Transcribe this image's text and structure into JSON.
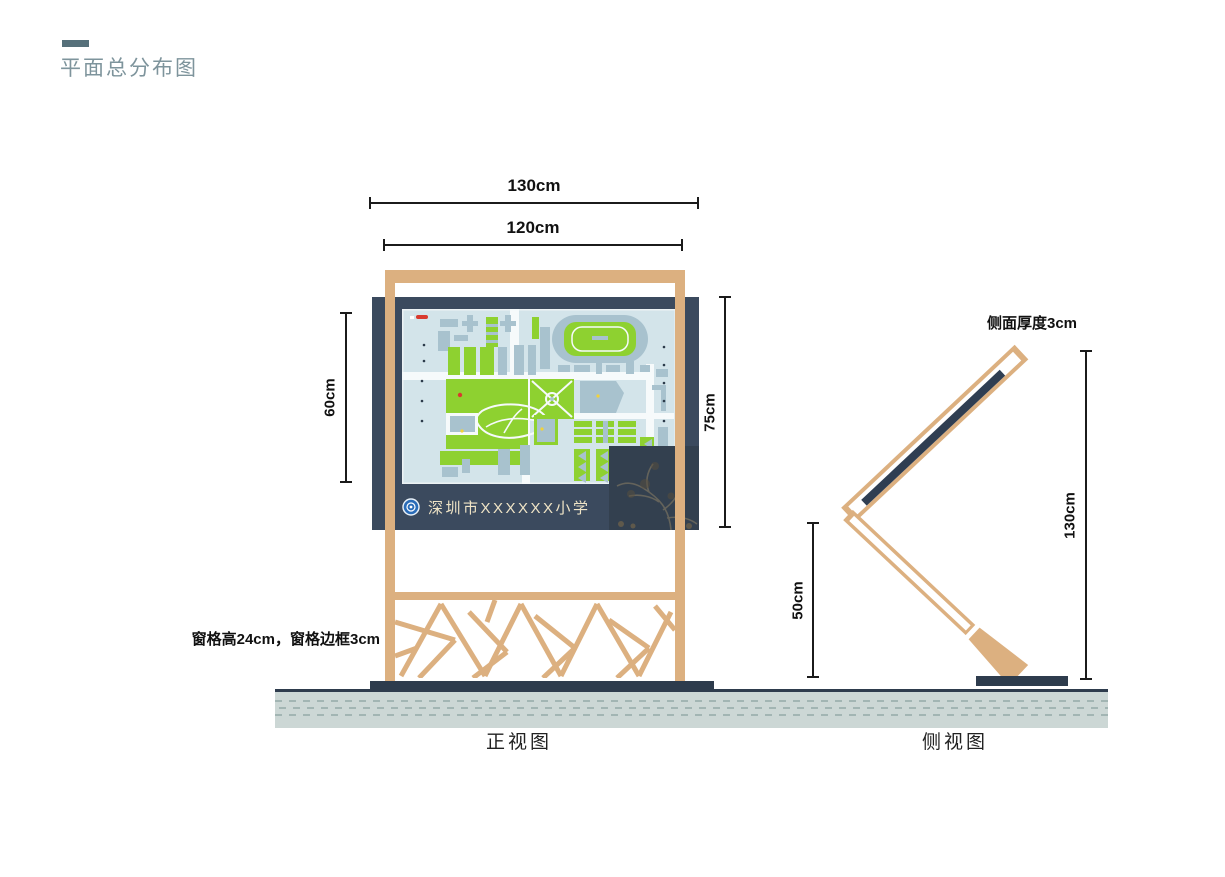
{
  "title": {
    "text": "平面总分布图"
  },
  "front_view": {
    "caption": "正视图",
    "school_name": "深圳市XXXXXX小学",
    "dims": {
      "total_width": "130cm",
      "frame_width": "120cm",
      "map_height": "60cm",
      "panel_height": "75cm"
    },
    "lattice_note": "窗格高24cm，窗格边框3cm"
  },
  "side_view": {
    "caption": "侧视图",
    "dims": {
      "thickness_note": "侧面厚度3cm",
      "total_height": "130cm",
      "ground_clearance": "50cm"
    }
  },
  "colors": {
    "wood": "#dcb080",
    "panel_navy": "#3b4a5e",
    "base_dark": "#2e3c4d",
    "map_green": "#8ed130",
    "map_building_gray": "#a8c2ce",
    "map_background": "#d3e4ea",
    "ground_band": "#ccd7d5",
    "title_teal": "#7e949c",
    "school_text_cream": "#efe4c6",
    "logo_blue": "#2a6cb8"
  }
}
